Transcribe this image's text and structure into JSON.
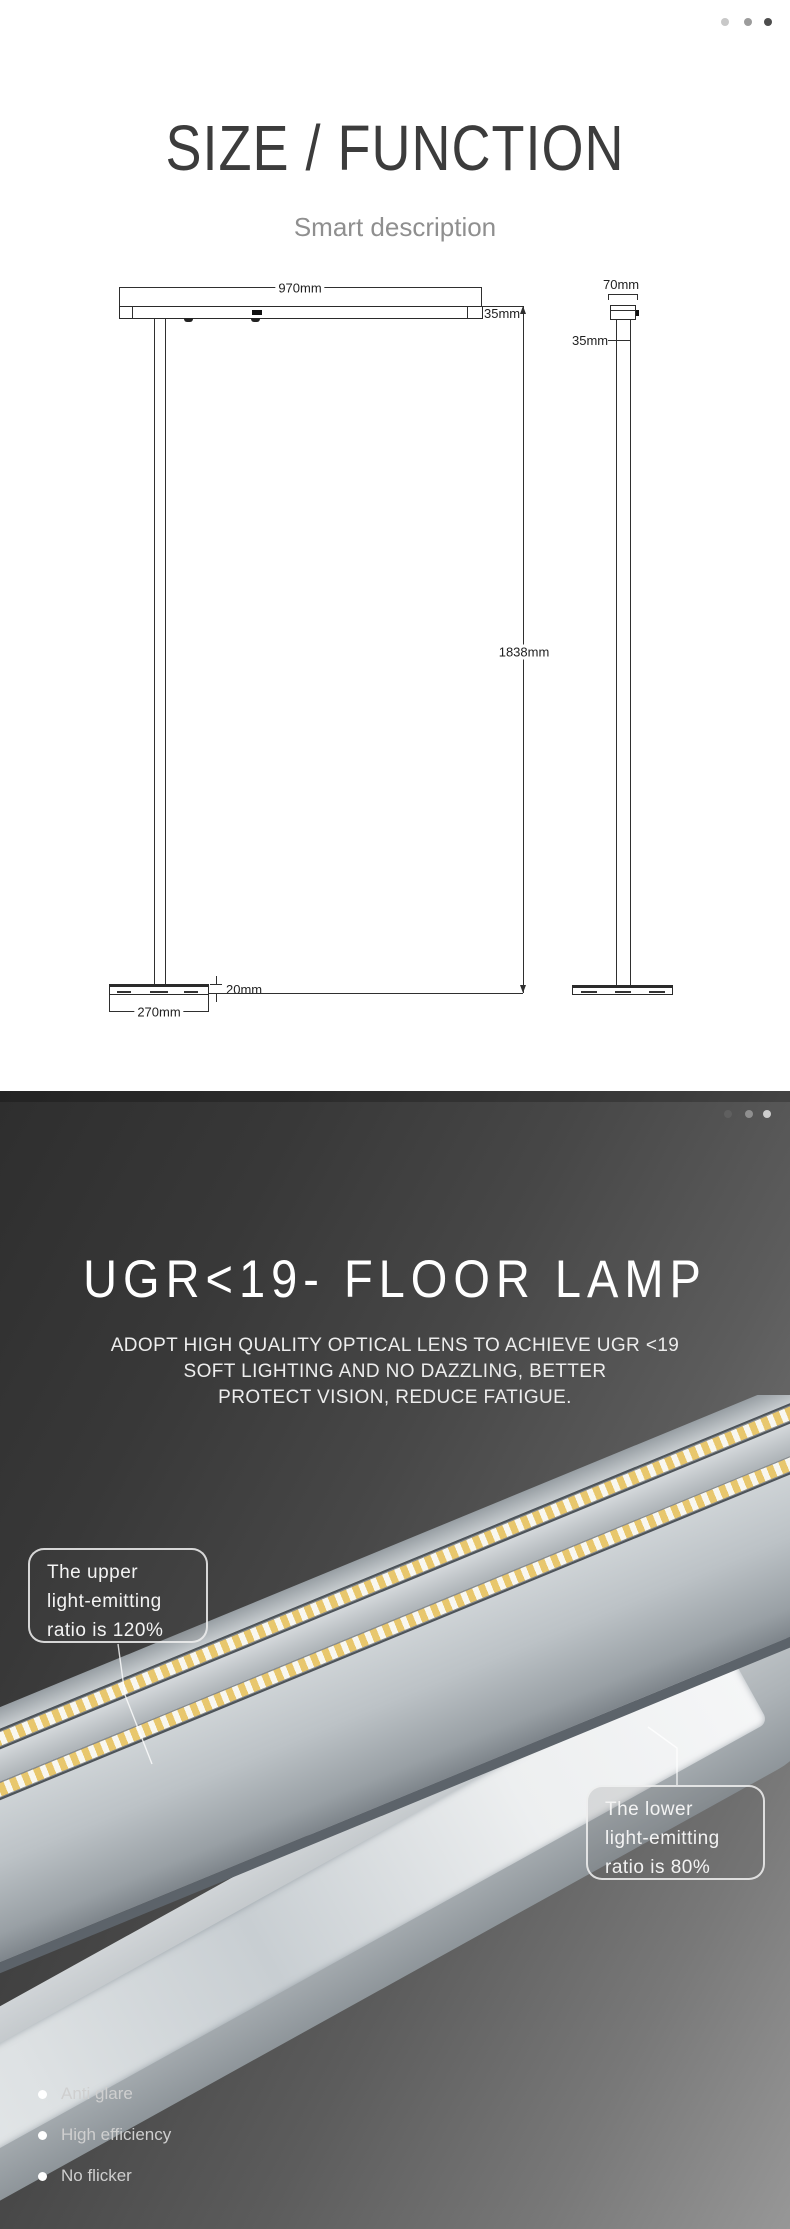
{
  "section_size": {
    "title": "SIZE / FUNCTION",
    "subtitle": "Smart description",
    "carousel_dots": [
      "inactive",
      "inactive",
      "active"
    ],
    "drawing": {
      "front_view": {
        "width_label": "970mm",
        "head_height_label": "35mm",
        "pole_height_label": "1838mm",
        "base_thickness_label": "20mm",
        "base_width_label": "270mm"
      },
      "side_view": {
        "head_width_label": "70mm",
        "pole_width_label": "35mm"
      }
    }
  },
  "section_ugr": {
    "title": "UGR<19- FLOOR LAMP",
    "subtitle_lines": [
      "ADOPT HIGH QUALITY OPTICAL LENS TO ACHIEVE UGR <19",
      "SOFT LIGHTING AND NO DAZZLING, BETTER",
      "PROTECT VISION, REDUCE FATIGUE."
    ],
    "carousel_dots": [
      "inactive",
      "inactive",
      "active"
    ],
    "callout_upper": {
      "line1": "The upper",
      "line2": "light-emitting",
      "line3": "ratio is 120%"
    },
    "callout_lower": {
      "line1": "The lower",
      "line2": "light-emitting",
      "line3": "ratio is 80%"
    },
    "features": [
      "Anti glare",
      "High efficiency",
      "No flicker"
    ]
  },
  "colors": {
    "dot_light": "#c8c8c8",
    "dot_mid": "#9c9c9c",
    "dot_dark": "#4d4d4d",
    "dot_dark_section_inactive1": "#5f5f5f",
    "dot_dark_section_inactive2": "#8f8f8f",
    "dot_dark_section_active": "#cdcdcd",
    "title_dark_text": "#3c3c3c",
    "subtitle_gray": "#8f8f8f",
    "dark_bg_start": "#2e2e2e",
    "dark_bg_end": "#979797",
    "led_chip": "#e8c76d"
  }
}
